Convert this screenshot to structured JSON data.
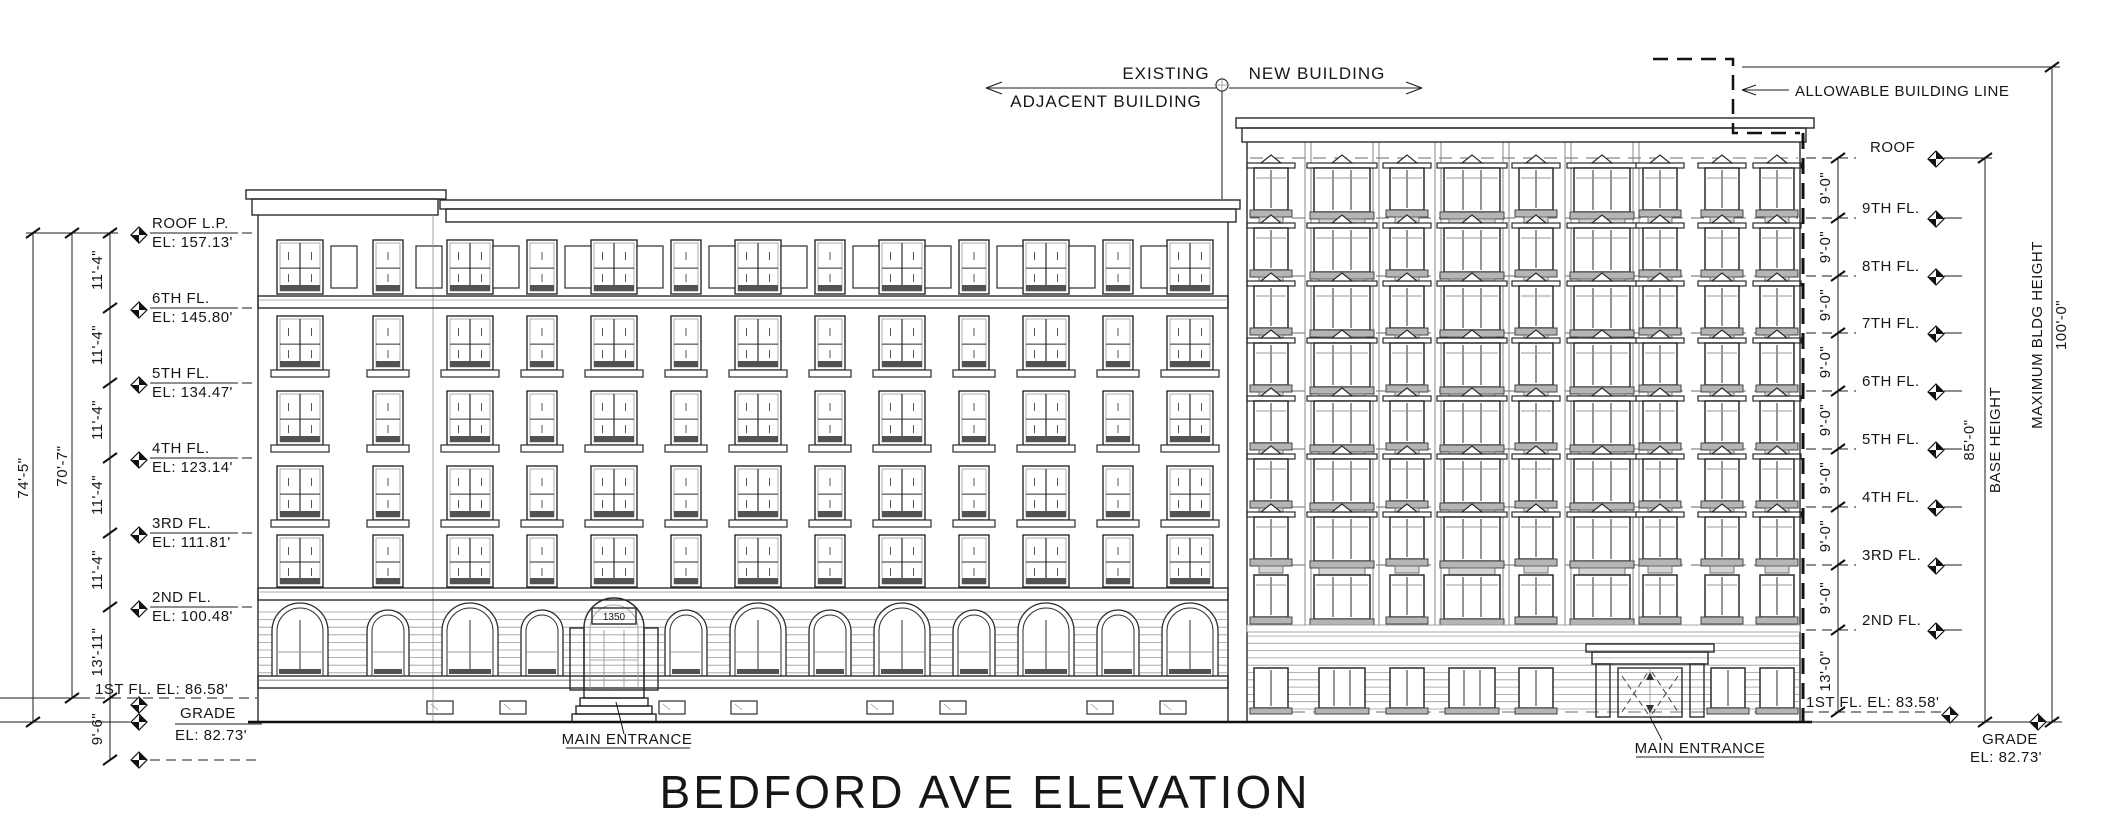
{
  "drawing_title": "BEDFORD AVE ELEVATION",
  "top_annotations": {
    "adjacent_building_line1": "EXISTING",
    "adjacent_building_line2": "ADJACENT BUILDING",
    "new_building": "NEW BUILDING",
    "allowable_building_line": "ALLOWABLE BUILDING LINE"
  },
  "left_building": {
    "address_sign": "1350",
    "entrance_label": "MAIN ENTRANCE",
    "levels": [
      {
        "label": "ROOF L.P.",
        "elevation": "EL: 157.13'"
      },
      {
        "label": "6TH FL.",
        "elevation": "EL: 145.80'"
      },
      {
        "label": "5TH FL.",
        "elevation": "EL: 134.47'"
      },
      {
        "label": "4TH FL.",
        "elevation": "EL: 123.14'"
      },
      {
        "label": "3RD FL.",
        "elevation": "EL: 111.81'"
      },
      {
        "label": "2ND FL.",
        "elevation": "EL: 100.48'"
      },
      {
        "label": "1ST FL. EL: 86.58'",
        "elevation": ""
      },
      {
        "label": "GRADE",
        "elevation": "EL: 82.73'"
      }
    ],
    "dimensions": {
      "roof_to_grade": "74'-5\"",
      "roof_to_first_floor": "70'-7\"",
      "typical_story": "11'-4\"",
      "second_to_first": "13'-11\"",
      "first_to_cellar": "9'-6\""
    }
  },
  "right_building": {
    "entrance_label": "MAIN ENTRANCE",
    "levels": [
      {
        "label": "ROOF"
      },
      {
        "label": "9TH FL."
      },
      {
        "label": "8TH FL."
      },
      {
        "label": "7TH FL."
      },
      {
        "label": "6TH FL."
      },
      {
        "label": "5TH FL."
      },
      {
        "label": "4TH FL."
      },
      {
        "label": "3RD FL."
      },
      {
        "label": "2ND FL."
      }
    ],
    "first_floor_label": "1ST FL. EL: 83.58'",
    "grade_label": "GRADE",
    "grade_elevation": "EL: 82.73'",
    "dimensions": {
      "typical_story": "9'-0\"",
      "second_to_first": "13'-0\"",
      "base_height_value": "85'-0\"",
      "base_height_label": "BASE HEIGHT",
      "max_height_label": "MAXIMUM BLDG HEIGHT",
      "max_height_value": "100'-0\""
    }
  },
  "colors": {
    "ink": "#161616",
    "line": "#2b2b2b",
    "light_line": "#8f8f8f",
    "sill_gray": "#b5b5b5",
    "shade_gray": "#555555",
    "background": "#ffffff"
  }
}
